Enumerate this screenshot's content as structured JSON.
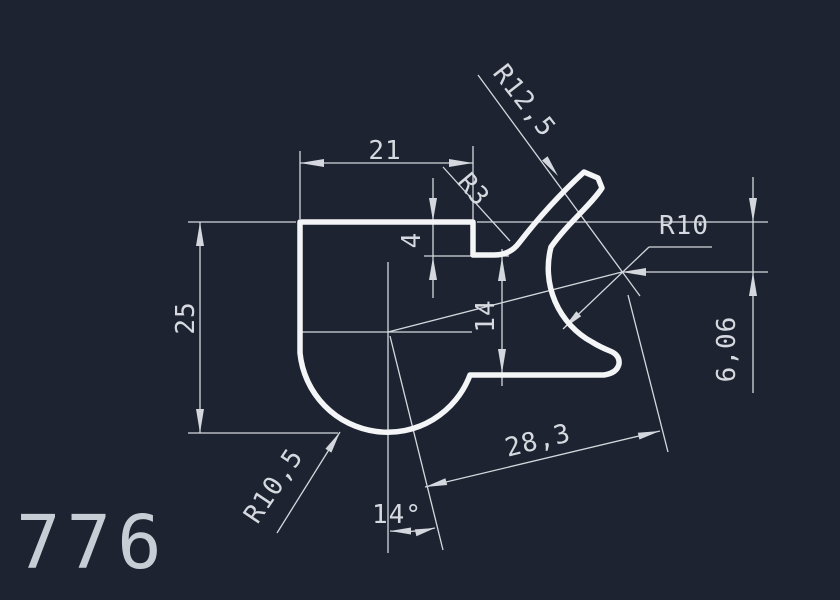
{
  "title": "CAD profile cross-section drawing",
  "part_number": "776",
  "labels": {
    "top_width": "21",
    "left_height": "25",
    "notch_depth": "4",
    "mid_height": "14",
    "fillet_radius": "R3",
    "hook_radius": "R12,5",
    "opening_radius": "R10",
    "center_offset": "6,06",
    "center_distance": "28,3",
    "bulb_radius": "R10,5",
    "tilt_angle": "14°"
  },
  "colors": {
    "background": "#1d2330",
    "profile_line": "#f4f5f7",
    "dimension_line": "#d4d8de",
    "text": "#d6dae0"
  }
}
